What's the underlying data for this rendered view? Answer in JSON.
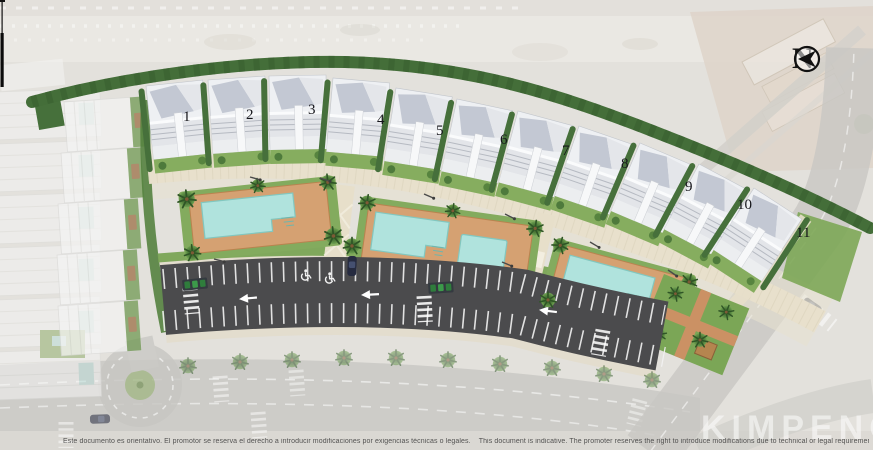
{
  "title": "Residential development site plan",
  "compass": {
    "label": "N"
  },
  "buildings": [
    {
      "label": "1"
    },
    {
      "label": "2"
    },
    {
      "label": "3"
    },
    {
      "label": "4"
    },
    {
      "label": "5"
    },
    {
      "label": "6"
    },
    {
      "label": "7"
    },
    {
      "label": "8"
    },
    {
      "label": "9"
    },
    {
      "label": "10"
    },
    {
      "label": "11"
    }
  ],
  "watermark": {
    "text": "KIMPENCI"
  },
  "disclaimer": {
    "es": "Este documento es orientativo. El promotor se reserva el derecho a introducir modificaciones por exigencias técnicas o legales.",
    "en": "This document is indicative. The promoter reserves the right to introduce modifications due to technical or legal requirements."
  },
  "colors": {
    "hedge": "#4a7140",
    "lawn": "#87ac62",
    "deck": "#d5a172",
    "pool": "#b0e3dd",
    "asphalt": "#4b4b4d",
    "path": "#e8e0cc"
  }
}
